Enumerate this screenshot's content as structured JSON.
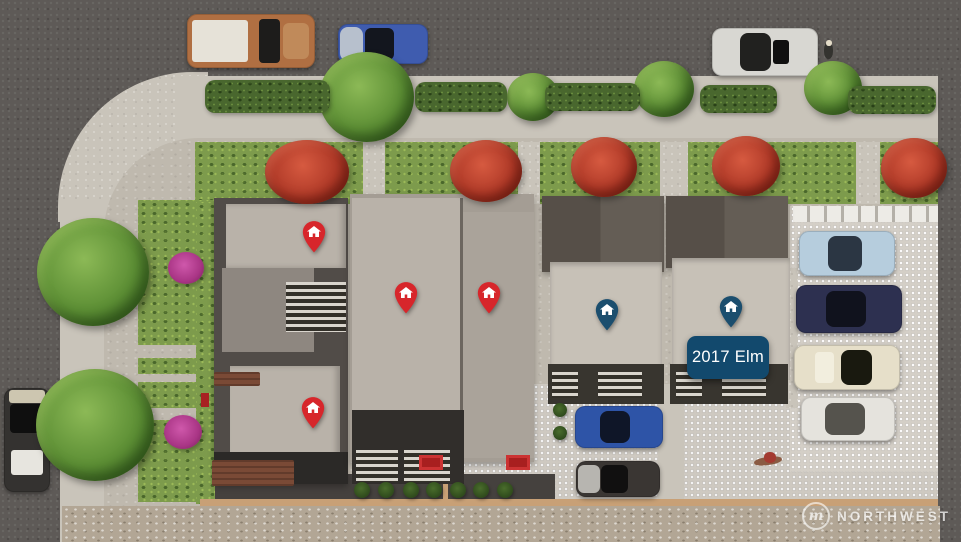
{
  "label": {
    "text": "2017 Elm"
  },
  "watermark": {
    "logo_letter": "m",
    "text": "NORTHWEST"
  },
  "colors": {
    "red_pin": "#d7262b",
    "blue_pin": "#1b4e6e",
    "label_bg": "#12496d",
    "label_text": "#ffffff"
  },
  "pins": [
    {
      "name": "red-house-pin-1",
      "color": "red",
      "x": 314,
      "y": 232
    },
    {
      "name": "red-house-pin-2",
      "color": "red",
      "x": 406,
      "y": 293
    },
    {
      "name": "red-house-pin-3",
      "color": "red",
      "x": 489,
      "y": 293
    },
    {
      "name": "red-house-pin-4",
      "color": "red",
      "x": 313,
      "y": 408
    },
    {
      "name": "blue-house-pin-1",
      "color": "blue",
      "x": 607,
      "y": 310
    },
    {
      "name": "blue-house-pin-2",
      "color": "blue",
      "x": 731,
      "y": 307
    }
  ],
  "cars": [
    {
      "name": "pickup-truck-street-top",
      "x": 187,
      "y": 14,
      "w": 128,
      "h": 54,
      "color": "#b06f42",
      "parts": [
        {
          "x": 4,
          "y": 12,
          "w": 44,
          "h": 76,
          "c": "#e6e2d8",
          "r": 3
        },
        {
          "x": 56,
          "y": 10,
          "w": 17,
          "h": 80,
          "c": "#1d1c1b",
          "r": 4
        },
        {
          "x": 75,
          "y": 16,
          "w": 20,
          "h": 68,
          "c": "#c08a5a",
          "r": 6
        }
      ]
    },
    {
      "name": "blue-sedan-street-top",
      "x": 338,
      "y": 24,
      "w": 90,
      "h": 40,
      "color": "#3f5caf",
      "parts": [
        {
          "x": 2,
          "y": 8,
          "w": 26,
          "h": 84,
          "c": "#b7c0cd",
          "r": 8
        },
        {
          "x": 30,
          "y": 10,
          "w": 32,
          "h": 80,
          "c": "#13161e",
          "r": 6
        }
      ]
    },
    {
      "name": "white-car-street-top",
      "x": 712,
      "y": 28,
      "w": 106,
      "h": 48,
      "color": "#d8d7d2",
      "parts": [
        {
          "x": 26,
          "y": 10,
          "w": 30,
          "h": 80,
          "c": "#21211f",
          "r": 8
        },
        {
          "x": 58,
          "y": 24,
          "w": 15,
          "h": 52,
          "c": "#101010",
          "r": 3
        }
      ]
    },
    {
      "name": "dark-suv-street-left",
      "x": 4,
      "y": 388,
      "w": 46,
      "h": 104,
      "color": "#343230",
      "parts": [
        {
          "x": 10,
          "y": 2,
          "w": 80,
          "h": 12,
          "c": "#cdc6b0",
          "r": 3
        },
        {
          "x": 12,
          "y": 15,
          "w": 76,
          "h": 28,
          "c": "#0f0f0f",
          "r": 4
        },
        {
          "x": 16,
          "y": 60,
          "w": 68,
          "h": 24,
          "c": "#e7e5df",
          "r": 3
        }
      ]
    },
    {
      "name": "light-blue-car-parking",
      "x": 799,
      "y": 231,
      "w": 96,
      "h": 45,
      "color": "#b6cddd",
      "parts": [
        {
          "x": 30,
          "y": 12,
          "w": 36,
          "h": 76,
          "c": "#2b3643",
          "r": 8
        }
      ]
    },
    {
      "name": "navy-car-parking",
      "x": 796,
      "y": 285,
      "w": 106,
      "h": 48,
      "color": "#2d3050",
      "parts": [
        {
          "x": 28,
          "y": 12,
          "w": 38,
          "h": 76,
          "c": "#10121d",
          "r": 8
        }
      ]
    },
    {
      "name": "cream-car-parking",
      "x": 794,
      "y": 345,
      "w": 106,
      "h": 45,
      "color": "#e6dfc9",
      "parts": [
        {
          "x": 44,
          "y": 12,
          "w": 30,
          "h": 76,
          "c": "#19190f",
          "r": 8
        },
        {
          "x": 20,
          "y": 16,
          "w": 18,
          "h": 68,
          "c": "#f2eede",
          "r": 4
        }
      ]
    },
    {
      "name": "white-car-parking",
      "x": 801,
      "y": 397,
      "w": 94,
      "h": 44,
      "color": "#e5e3dd",
      "parts": [
        {
          "x": 26,
          "y": 14,
          "w": 42,
          "h": 72,
          "c": "#55534d",
          "r": 8
        }
      ]
    },
    {
      "name": "blue-car-courtyard",
      "x": 575,
      "y": 406,
      "w": 88,
      "h": 42,
      "color": "#2e54a7",
      "parts": [
        {
          "x": 28,
          "y": 12,
          "w": 34,
          "h": 76,
          "c": "#0f1628",
          "r": 8
        }
      ]
    },
    {
      "name": "black-silver-car-courtyard",
      "x": 576,
      "y": 461,
      "w": 84,
      "h": 36,
      "color": "#3a3633",
      "parts": [
        {
          "x": 2,
          "y": 10,
          "w": 26,
          "h": 80,
          "c": "#b7b5b0",
          "r": 6
        },
        {
          "x": 30,
          "y": 12,
          "w": 32,
          "h": 76,
          "c": "#111010",
          "r": 6
        }
      ]
    }
  ],
  "vegetation": [
    {
      "name": "street-tree",
      "type": "green",
      "x": 366,
      "y": 97,
      "w": 95,
      "h": 90
    },
    {
      "name": "street-tree",
      "type": "green",
      "x": 533,
      "y": 97,
      "w": 52,
      "h": 48
    },
    {
      "name": "street-tree",
      "type": "green",
      "x": 664,
      "y": 89,
      "w": 60,
      "h": 56
    },
    {
      "name": "street-tree",
      "type": "green",
      "x": 833,
      "y": 88,
      "w": 58,
      "h": 54
    },
    {
      "name": "large-tree-left",
      "type": "green",
      "x": 93,
      "y": 272,
      "w": 112,
      "h": 108
    },
    {
      "name": "large-tree-left",
      "type": "green",
      "x": 95,
      "y": 425,
      "w": 118,
      "h": 112
    },
    {
      "name": "magenta-bush",
      "type": "magenta",
      "x": 186,
      "y": 268,
      "w": 36,
      "h": 32
    },
    {
      "name": "magenta-bush",
      "type": "magenta",
      "x": 183,
      "y": 432,
      "w": 38,
      "h": 34
    },
    {
      "name": "red-tree",
      "type": "red",
      "x": 307,
      "y": 172,
      "w": 84,
      "h": 64
    },
    {
      "name": "red-tree",
      "type": "red",
      "x": 486,
      "y": 171,
      "w": 72,
      "h": 62
    },
    {
      "name": "red-tree",
      "type": "red",
      "x": 604,
      "y": 167,
      "w": 66,
      "h": 60
    },
    {
      "name": "red-tree",
      "type": "red",
      "x": 746,
      "y": 166,
      "w": 68,
      "h": 60
    },
    {
      "name": "red-tree",
      "type": "red",
      "x": 914,
      "y": 168,
      "w": 66,
      "h": 60
    },
    {
      "name": "hedge",
      "type": "hedge",
      "x": 267,
      "y": 96,
      "w": 125,
      "h": 33
    },
    {
      "name": "hedge",
      "type": "hedge",
      "x": 461,
      "y": 97,
      "w": 92,
      "h": 30
    },
    {
      "name": "hedge",
      "type": "hedge",
      "x": 592,
      "y": 97,
      "w": 95,
      "h": 28
    },
    {
      "name": "hedge",
      "type": "hedge",
      "x": 738,
      "y": 99,
      "w": 77,
      "h": 28
    },
    {
      "name": "hedge",
      "type": "hedge",
      "x": 892,
      "y": 100,
      "w": 88,
      "h": 28
    },
    {
      "name": "courtyard-shrub",
      "type": "bush",
      "x": 362,
      "y": 490,
      "w": 16,
      "h": 16
    },
    {
      "name": "courtyard-shrub",
      "type": "bush",
      "x": 386,
      "y": 490,
      "w": 16,
      "h": 16
    },
    {
      "name": "courtyard-shrub",
      "type": "bush",
      "x": 411,
      "y": 490,
      "w": 16,
      "h": 16
    },
    {
      "name": "courtyard-shrub",
      "type": "bush",
      "x": 434,
      "y": 490,
      "w": 16,
      "h": 16
    },
    {
      "name": "courtyard-shrub",
      "type": "bush",
      "x": 458,
      "y": 490,
      "w": 16,
      "h": 16
    },
    {
      "name": "courtyard-shrub",
      "type": "bush",
      "x": 481,
      "y": 490,
      "w": 16,
      "h": 16
    },
    {
      "name": "courtyard-shrub",
      "type": "bush",
      "x": 505,
      "y": 490,
      "w": 16,
      "h": 16
    },
    {
      "name": "courtyard-shrub",
      "type": "bush",
      "x": 560,
      "y": 410,
      "w": 14,
      "h": 14
    },
    {
      "name": "courtyard-shrub",
      "type": "bush",
      "x": 560,
      "y": 433,
      "w": 14,
      "h": 14
    }
  ]
}
